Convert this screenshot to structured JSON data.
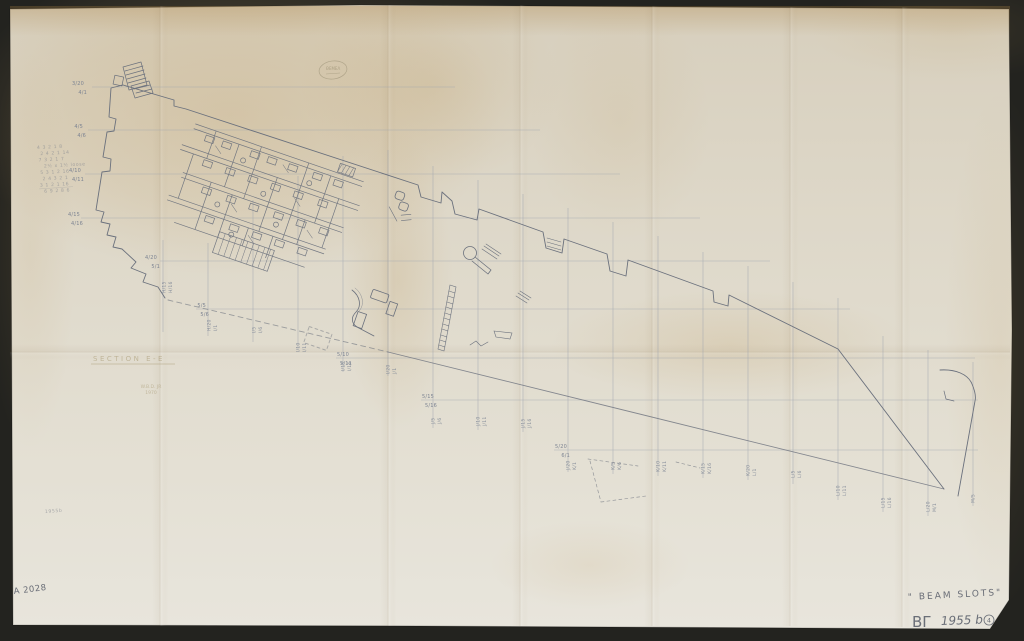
{
  "document": {
    "type_note": "scanned pencil excavation plan",
    "captions": {
      "beam_slots": "\" BEAM  SLOTS\"",
      "series_mark": "ΒΓ",
      "year_label": "1955 b",
      "circled_note": "4",
      "inventory_number": "A 2028",
      "faint_year_note": "1955b",
      "section_title": "SECTION  E-E",
      "credit_name": "W.B.D. JR",
      "credit_year": "1970",
      "blob_note": "ΘΕΜΕΛ"
    },
    "tally_scribbles": [
      "4 3 2 1 8",
      "2 4 2 1 14",
      "7 3 2 1 7",
      "2½ x 1½ loose",
      "5 3 1 2 16",
      "2 4 3 2 1",
      "3 1 2 1 16",
      "6 9 2 8 6"
    ],
    "palette": {
      "backdrop": "#23231f",
      "paper": "#ded7c7",
      "paper_light": "#e9e6dd",
      "stain": "#c09a5a",
      "ink": "#6b717d",
      "grid_line": "#9aa1ad",
      "pencil_text": "#7d8492",
      "faint_ink": "#a09066"
    }
  },
  "grid": {
    "rows": [
      {
        "a": "3/20",
        "b": "4/1"
      },
      {
        "a": "4/5",
        "b": "4/6"
      },
      {
        "a": "4/10",
        "b": "4/11"
      },
      {
        "a": "4/15",
        "b": "4/16"
      },
      {
        "a": "4/20",
        "b": "5/1"
      },
      {
        "a": "5/5",
        "b": "5/6"
      },
      {
        "a": "5/10",
        "b": "5/11"
      },
      {
        "a": "5/15",
        "b": "5/16"
      },
      {
        "a": "5/20",
        "b": "6/1"
      }
    ],
    "cols": [
      {
        "a": "H/15",
        "b": "H/16"
      },
      {
        "a": "H/20",
        "b": "I/1"
      },
      {
        "a": "I/5",
        "b": "I/6"
      },
      {
        "a": "I/10",
        "b": "I/11"
      },
      {
        "a": "I/15",
        "b": "I/16"
      },
      {
        "a": "I/20",
        "b": "J/1"
      },
      {
        "a": "J/5",
        "b": "J/6"
      },
      {
        "a": "J/10",
        "b": "J/11"
      },
      {
        "a": "J/15",
        "b": "J/16"
      },
      {
        "a": "J/20",
        "b": "K/1"
      },
      {
        "a": "K/5",
        "b": "K/6"
      },
      {
        "a": "K/10",
        "b": "K/11"
      },
      {
        "a": "K/15",
        "b": "K/16"
      },
      {
        "a": "K/20",
        "b": "L/1"
      },
      {
        "a": "L/5",
        "b": "L/6"
      },
      {
        "a": "L/10",
        "b": "L/11"
      },
      {
        "a": "L/15",
        "b": "L/16"
      },
      {
        "a": "L/20",
        "b": "M/1"
      },
      {
        "a": "M/5",
        "b": ""
      }
    ]
  }
}
